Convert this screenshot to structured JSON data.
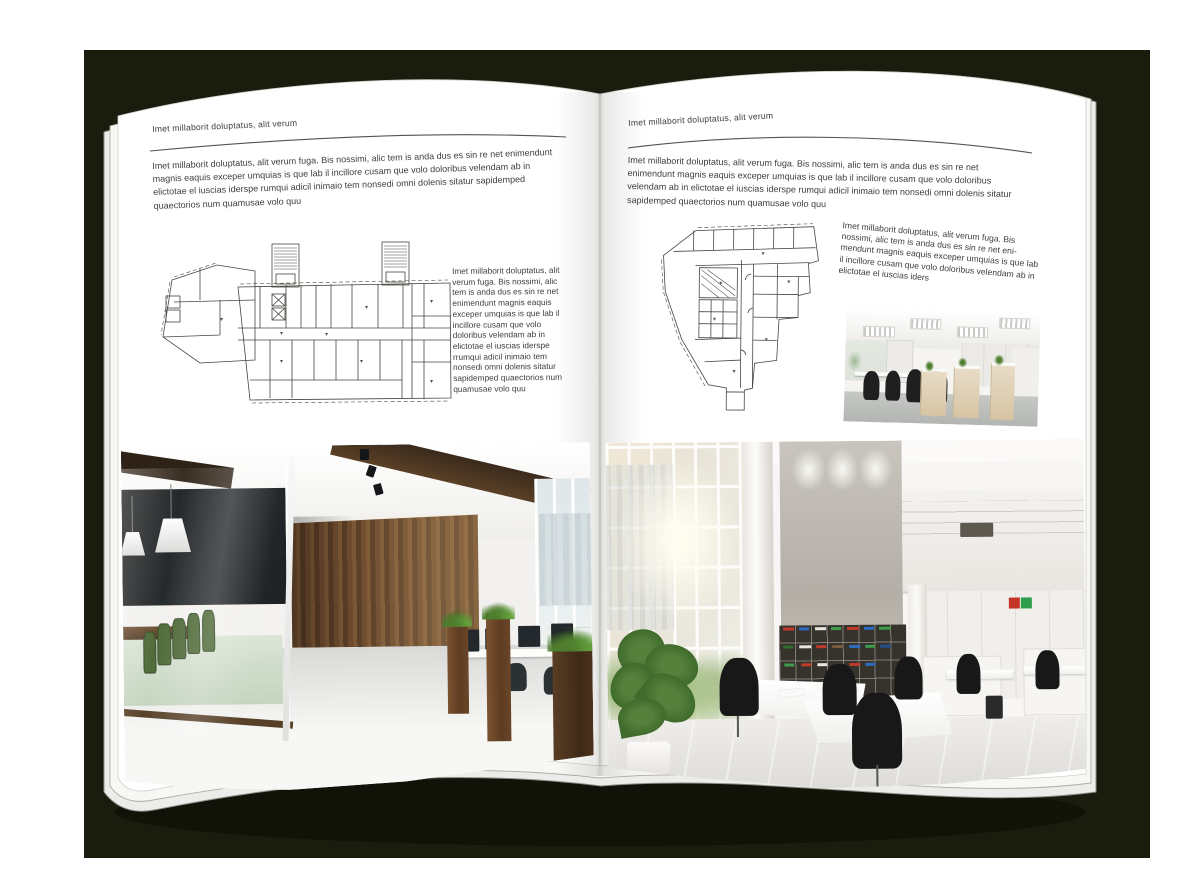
{
  "document_type": "magazine-spread-mockup",
  "colors": {
    "backdrop": "#1a1c0d",
    "page": "#ffffff",
    "text": "#3d3d3d",
    "rule": "#53534d"
  },
  "left_page": {
    "header": "Imet millaborit doluptatus, alit verum",
    "intro": "Imet millaborit doluptatus, alit verum fuga. Bis nossimi, alic tem is anda dus es sin re net enimendunt magnis eaquis exceper umquias is que lab il incillore cusam que volo doloribus velendam ab in elictotae el iuscias iderspe rumqui adicil inimaio tem nonsedi omni dolenis sitatur sapidemped quaectorios num quamusae volo quu",
    "side_text": "Imet millaborit doluptatus, alit verum fuga. Bis nossimi, alic tem is anda dus es sin re net enimendunt magnis eaquis exceper umquias is que lab il incillore cusam que volo doloribus velendam ab in elictotae el iuscias iderspe rrumqui adicil inimaio tem nonsedi omni dolenis sitatur sapidemped quaectorios num quamusae volo quu",
    "floor_plan": "wide-slab building floor plan with two stair towers",
    "photo": "dark loft office with glass meeting room, wood wall and workstations"
  },
  "right_page": {
    "header": "Imet millaborit doluptatus, alit verum",
    "intro": "Imet millaborit doluptatus, alit verum fuga. Bis nossimi, alic tem is anda dus es sin re net enimendunt magnis eaquis exceper umquias is que lab il incillore cusam que volo doloribus velendam ab in elictotae el iuscias iderspe rumqui adicil inimaio tem nonsedi omni dolenis sitatur sapidemped quaectorios num quamusae volo quu",
    "side_text": "Imet millaborit doluptatus, alit verum fuga. Bis nossimi, alic tem is anda dus es sin re net eni-mendunt magnis eaquis exceper umquias is que lab il incillore cusam que volo doloribus velendam ab in elictotae el iuscias iders",
    "floor_plan": "tapered tower floor plan",
    "photo_small": "open-plan office with white desks and wood cabinets",
    "photo_large": "double-height white office with window wall, concrete wall and binder shelves"
  }
}
